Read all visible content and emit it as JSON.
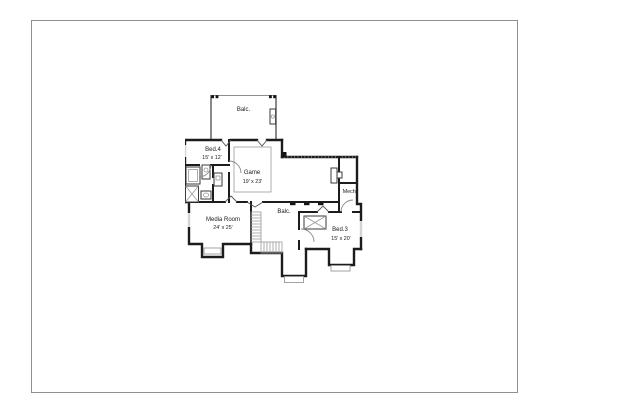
{
  "window": {
    "background": "#ffffff",
    "canvas_border_color": "#8f8f8f"
  },
  "floor_plan": {
    "drawing_type": "architectural floor plan, black line work on white",
    "colors": {
      "wall": "#1c1c1c",
      "interior_detail": "#555555",
      "light_detail": "#999999",
      "text": "#1a1a1a"
    },
    "rooms": {
      "balcony_top": {
        "label": "Balc."
      },
      "bed4": {
        "label": "Bed.4",
        "dims": "15' x 12'"
      },
      "game": {
        "label": "Game",
        "dims": "19' x 23'"
      },
      "mech": {
        "label": "Mech."
      },
      "media_room": {
        "label": "Media Room",
        "dims": "24' x 25'"
      },
      "balcony_center": {
        "label": "Balc."
      },
      "bed3": {
        "label": "Bed.3",
        "dims": "15' x 20'"
      }
    }
  }
}
